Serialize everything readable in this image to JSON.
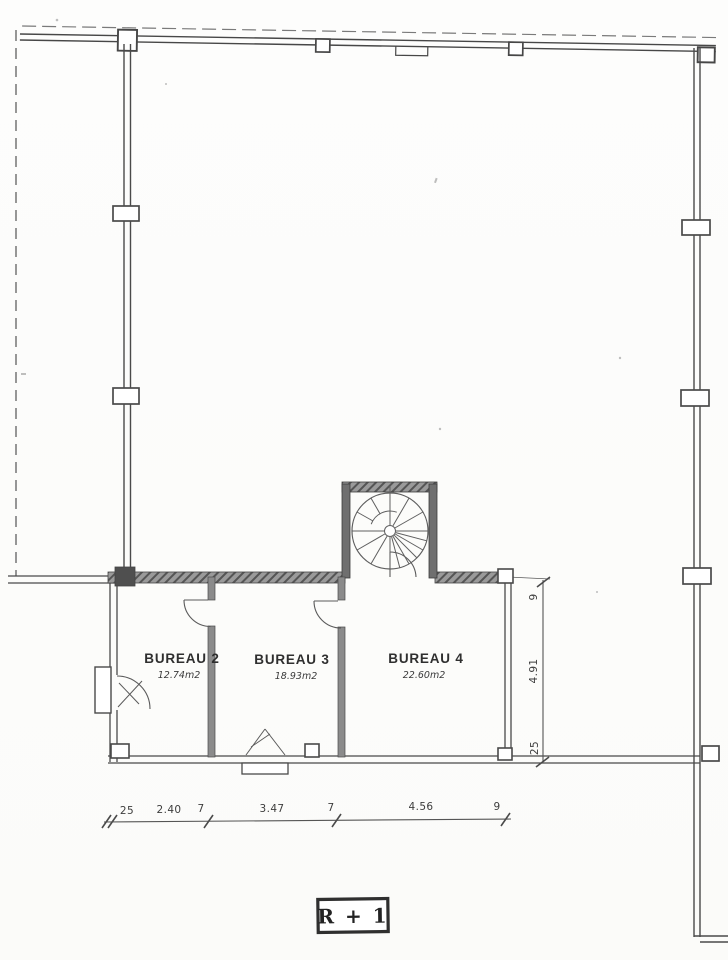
{
  "document": {
    "kind": "scanned architectural floor plan",
    "level_label": "R + 1"
  },
  "rooms": [
    {
      "name": "BUREAU 2",
      "area": "12.74m2"
    },
    {
      "name": "BUREAU 3",
      "area": "18.93m2"
    },
    {
      "name": "BUREAU 4",
      "area": "22.60m2"
    }
  ],
  "dimensions": {
    "horizontal": [
      "25",
      "2.40",
      "7",
      "3.47",
      "7",
      "4.56",
      "9"
    ],
    "vertical": [
      "9",
      "4.91",
      "25"
    ]
  },
  "colors": {
    "ink": "#4a4a4a",
    "wall_fill": "#8b8b8b",
    "alcove_wall": "#6f6f6f",
    "paper": "#fcfcfb"
  }
}
